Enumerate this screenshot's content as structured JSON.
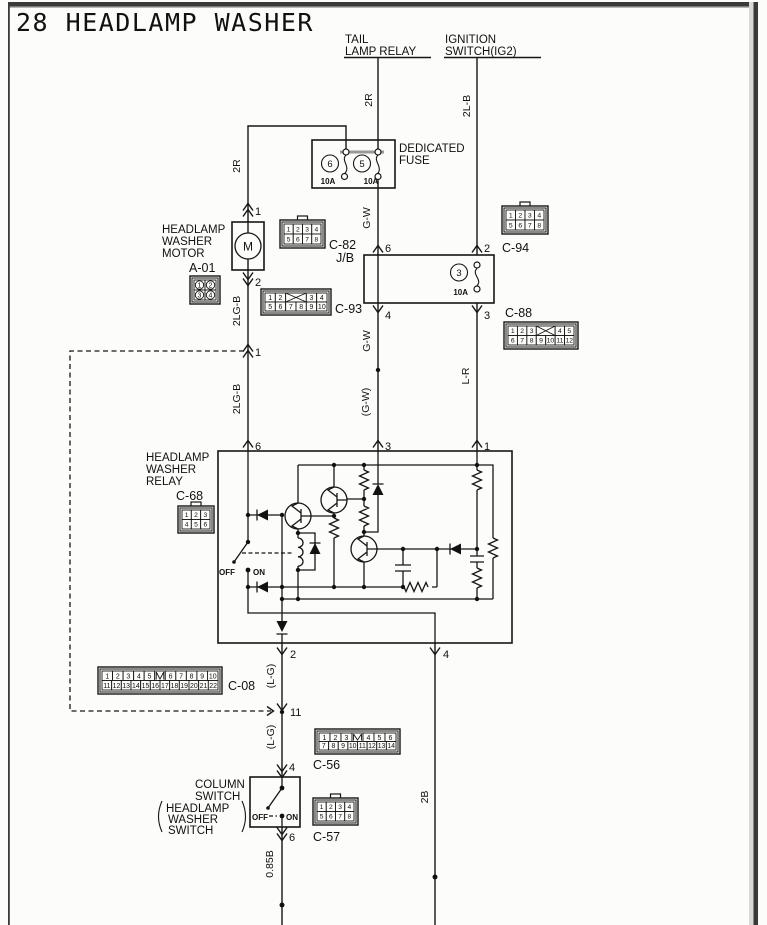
{
  "title": "28 HEADLAMP WASHER",
  "feeds": {
    "tail": {
      "l1": "TAIL",
      "l2": "LAMP RELAY",
      "wire": "2R"
    },
    "ign": {
      "l1": "IGNITION",
      "l2": "SWITCH(IG2)",
      "wire": "2L-B"
    }
  },
  "fusebox": {
    "l1": "DEDICATED",
    "l2": "FUSE",
    "f6": "6",
    "f6a": "10A",
    "f5": "5",
    "f5a": "10A"
  },
  "motor": {
    "l1": "HEADLAMP",
    "l2": "WASHER",
    "l3": "MOTOR",
    "sym": "M",
    "p1": "1",
    "p2": "2"
  },
  "jb": {
    "label": "J/B",
    "f3": "3",
    "f3a": "10A",
    "pin6": "6",
    "pin2": "2",
    "pin4": "4",
    "pin3": "3"
  },
  "junction": {
    "pin1": "1",
    "pin11": "11"
  },
  "relay": {
    "l1": "HEADLAMP",
    "l2": "WASHER",
    "l3": "RELAY",
    "pin6": "6",
    "pin3": "3",
    "pin1": "1",
    "pin2": "2",
    "pin4": "4",
    "off": "OFF",
    "on": "ON"
  },
  "colsw": {
    "l1": "COLUMN",
    "l2": "SWITCH",
    "p1": "HEADLAMP",
    "p2": "WASHER",
    "p3": "SWITCH",
    "off": "OFF",
    "on": "ON",
    "pin4": "4",
    "pin6": "6"
  },
  "wires": {
    "r2_feed": "2R",
    "lb2": "2L-B",
    "r2": "2R",
    "gw1": "G-W",
    "gw2": "G-W",
    "gw3": "(G-W)",
    "lgb1": "2LG-B",
    "lgb2": "2LG-B",
    "lr": "L-R",
    "lg1": "(L-G)",
    "lg2": "(L-G)",
    "b085": "0.85B",
    "b2": "2B"
  },
  "connector_labels": {
    "a01": "A-01",
    "c82": "C-82",
    "c93": "C-93",
    "c94": "C-94",
    "c88": "C-88",
    "c68": "C-68",
    "c08": "C-08",
    "c56": "C-56",
    "c57": "C-57"
  },
  "connectors": [
    {
      "key": "a01",
      "x": 190,
      "y": 276,
      "w": 30,
      "h": 28,
      "circled": true,
      "rows": [
        [
          "1",
          "2"
        ],
        [
          "3",
          "4"
        ]
      ]
    },
    {
      "key": "c82",
      "x": 280,
      "y": 220,
      "w": 45,
      "h": 28,
      "tab": true,
      "rows": [
        [
          "1",
          "2",
          "3",
          "4"
        ],
        [
          "5",
          "6",
          "7",
          "8"
        ]
      ]
    },
    {
      "key": "c93",
      "x": 261,
      "y": 289,
      "w": 70,
      "h": 26,
      "rows": [
        [
          "1",
          "2",
          "X:2",
          "3",
          "4"
        ],
        [
          "5",
          "6",
          "7",
          "8",
          "9",
          "10"
        ]
      ]
    },
    {
      "key": "c94",
      "x": 502,
      "y": 206,
      "w": 46,
      "h": 28,
      "tab": true,
      "rows": [
        [
          "1",
          "2",
          "3",
          "4"
        ],
        [
          "5",
          "6",
          "7",
          "8"
        ]
      ]
    },
    {
      "key": "c88",
      "x": 504,
      "y": 322,
      "w": 74,
      "h": 27,
      "rows": [
        [
          "1",
          "2",
          "3",
          "X:2",
          "4",
          "5"
        ],
        [
          "6",
          "7",
          "8",
          "9",
          "10",
          "11",
          "12"
        ]
      ]
    },
    {
      "key": "c68",
      "x": 178,
      "y": 506,
      "w": 36,
      "h": 27,
      "tab": true,
      "rows": [
        [
          "1",
          "2",
          "3"
        ],
        [
          "4",
          "5",
          "6"
        ]
      ]
    },
    {
      "key": "c08",
      "x": 98,
      "y": 667,
      "w": 124,
      "h": 27,
      "rows": [
        [
          "1",
          "2",
          "3",
          "4",
          "5",
          "M",
          "6",
          "7",
          "8",
          "9",
          "10"
        ],
        [
          "11",
          "12",
          "13",
          "14",
          "15",
          "16",
          "17",
          "18",
          "19",
          "20",
          "21",
          "22"
        ]
      ]
    },
    {
      "key": "c56",
      "x": 315,
      "y": 729,
      "w": 85,
      "h": 25,
      "rows": [
        [
          "1",
          "2",
          "3",
          "M",
          "4",
          "5",
          "6"
        ],
        [
          "7",
          "8",
          "9",
          "10",
          "11",
          "12",
          "13",
          "14"
        ]
      ]
    },
    {
      "key": "c57",
      "x": 313,
      "y": 798,
      "w": 45,
      "h": 27,
      "tab": true,
      "rows": [
        [
          "1",
          "2",
          "3",
          "4"
        ],
        [
          "5",
          "6",
          "7",
          "8"
        ]
      ]
    }
  ]
}
